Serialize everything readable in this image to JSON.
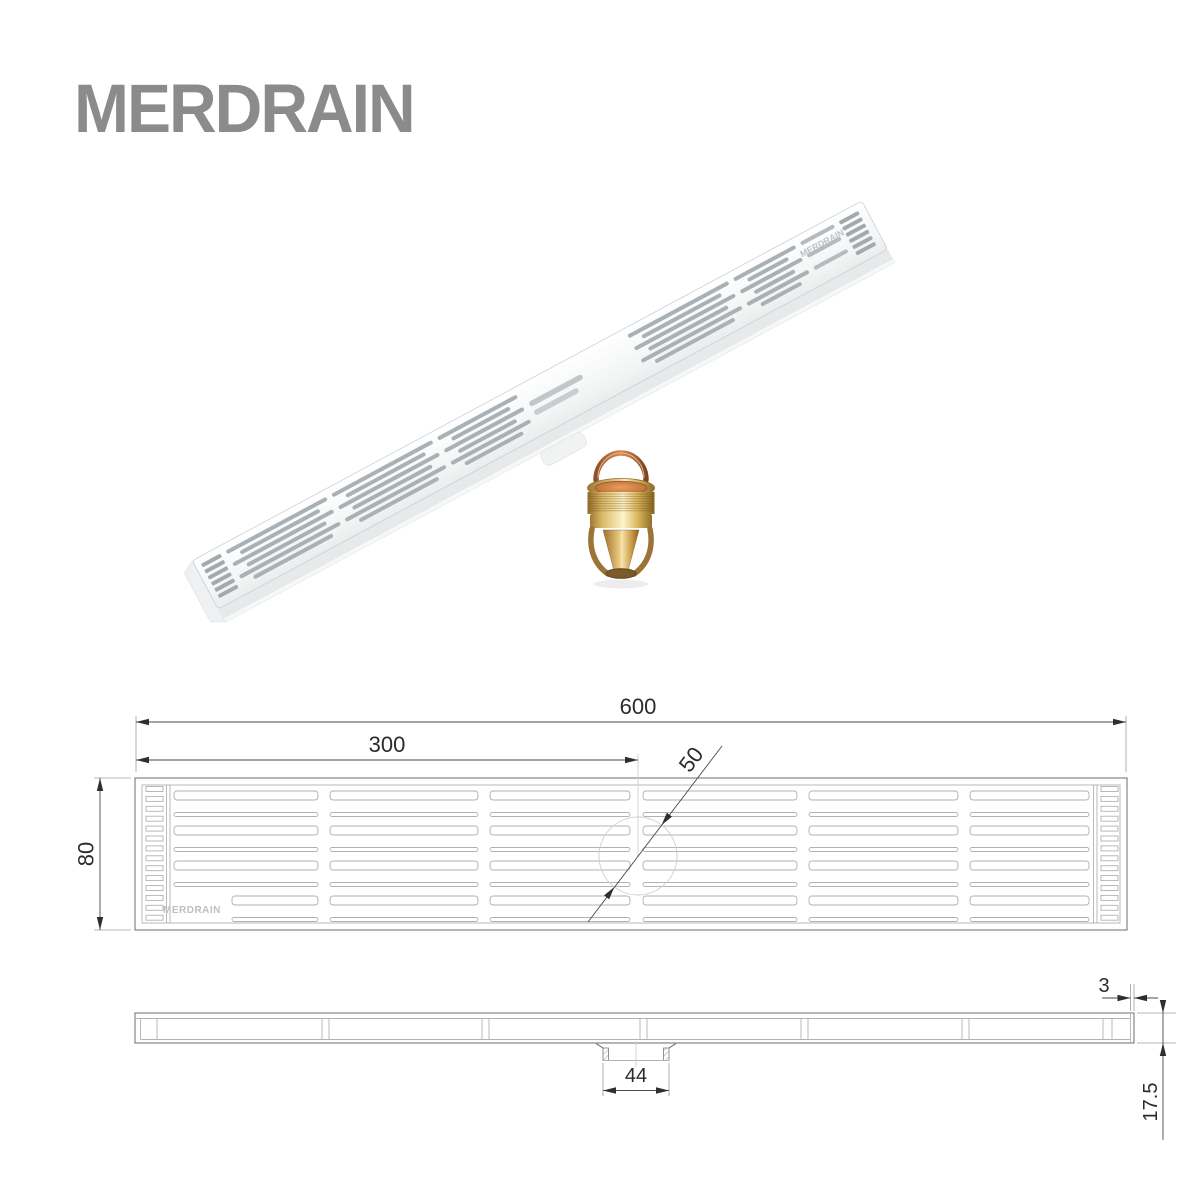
{
  "brand": {
    "logo_text": "MERDRAIN",
    "logo_color": "#8b8b8b"
  },
  "render": {
    "grate_engraving": "MERDRAIN",
    "grate_base_color": "#f4f6f6",
    "grate_slot_color": "#a9b0b6",
    "core_gold_color": "#d9b254",
    "core_copper_color": "#c07a42"
  },
  "drawing": {
    "outline_color": "#7a7a7a",
    "dimension_text_color": "#2b2b2b",
    "top_view": {
      "engraving": "MERDRAIN",
      "dims": {
        "overall_length": "600",
        "center_offset": "300",
        "hole_diameter": "50",
        "width": "80"
      }
    },
    "side_view": {
      "dims": {
        "edge_thickness": "3",
        "outlet_width": "44",
        "profile_height": "17.5"
      }
    }
  }
}
